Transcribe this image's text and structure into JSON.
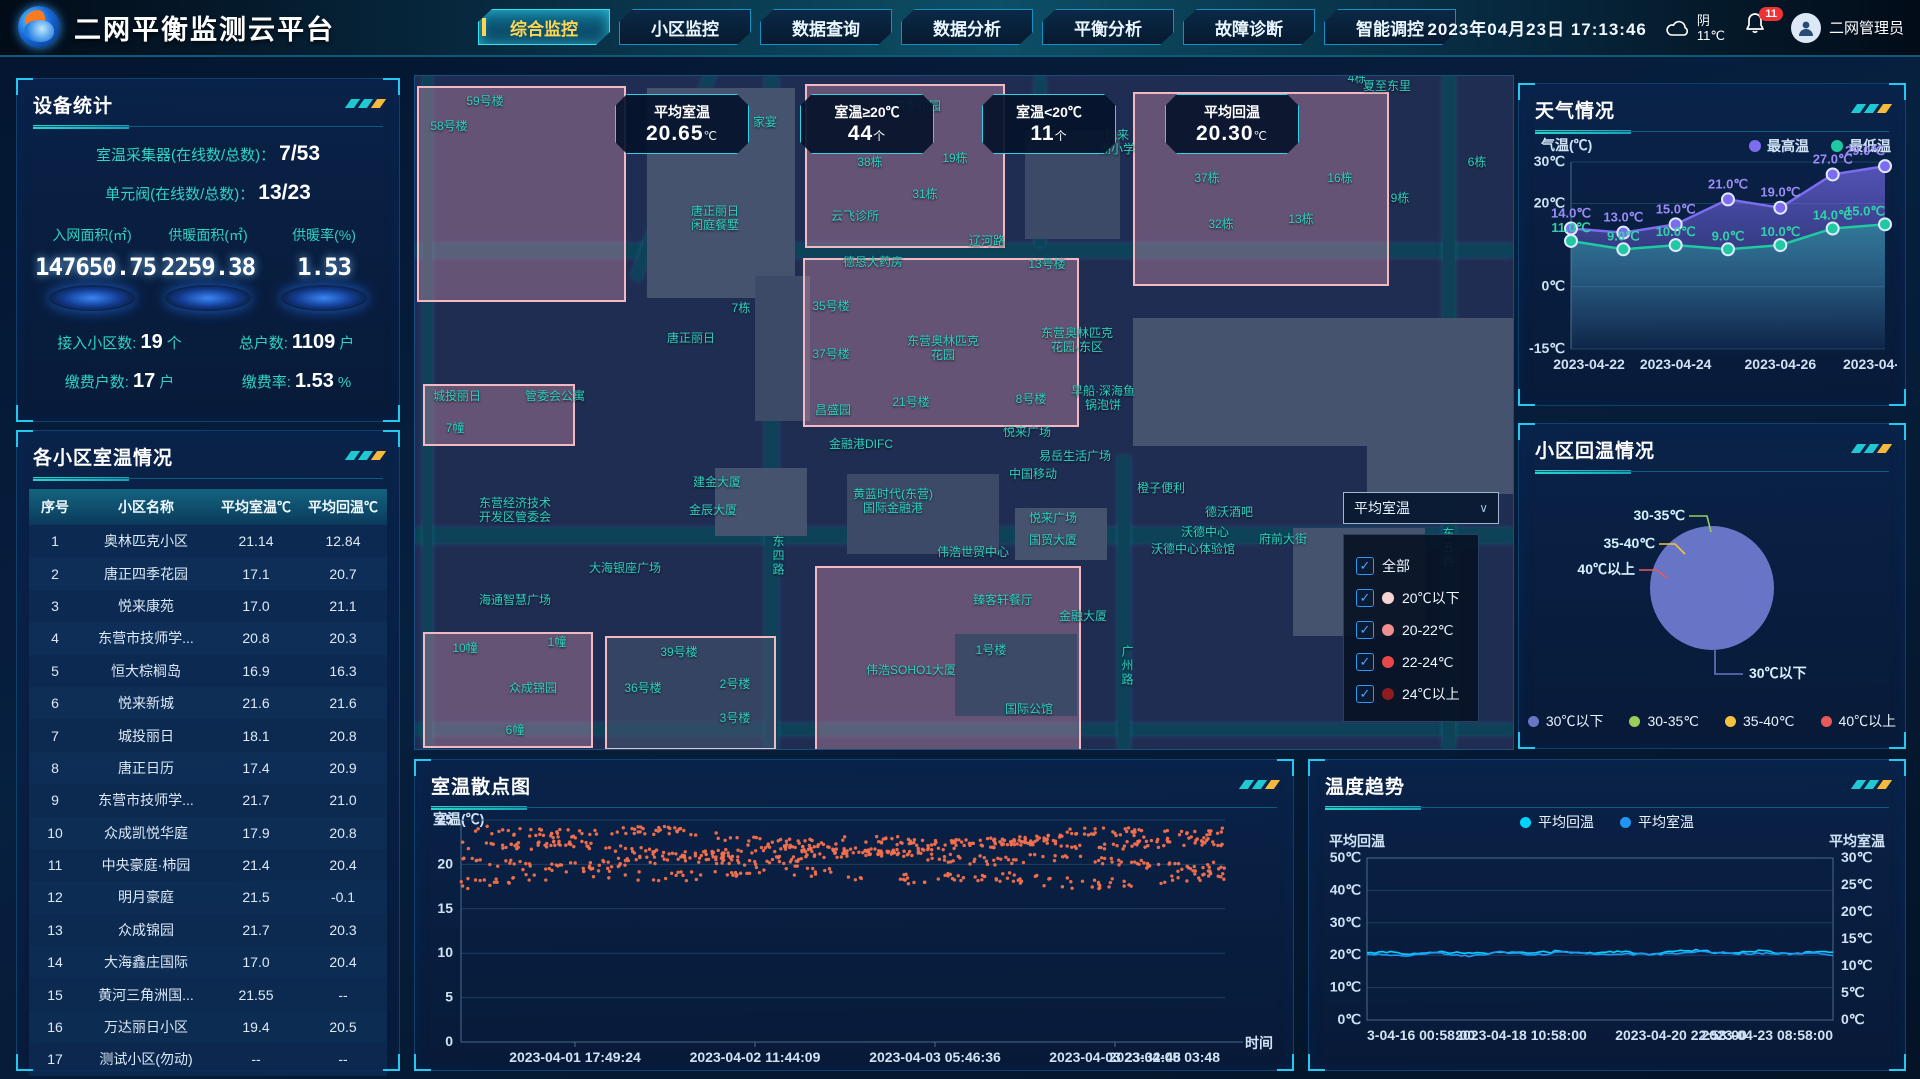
{
  "header": {
    "title": "二网平衡监测云平台",
    "nav": [
      {
        "label": "综合监控",
        "active": true
      },
      {
        "label": "小区监控",
        "active": false
      },
      {
        "label": "数据查询",
        "active": false
      },
      {
        "label": "数据分析",
        "active": false
      },
      {
        "label": "平衡分析",
        "active": false
      },
      {
        "label": "故障诊断",
        "active": false
      },
      {
        "label": "智能调控",
        "active": false
      }
    ],
    "datetime": "2023年04月23日 17:13:46",
    "weather_text": "阴",
    "weather_temp": "11℃",
    "notification_count": "11",
    "username": "二网管理员"
  },
  "device_stats": {
    "title": "设备统计",
    "rows": [
      {
        "label": "室温采集器(在线数/总数)：",
        "value": "7/53"
      },
      {
        "label": "单元阀(在线数/总数)：",
        "value": "13/23"
      }
    ],
    "gauges": [
      {
        "label": "入网面积(㎡)",
        "value": "147650.75"
      },
      {
        "label": "供暖面积(㎡)",
        "value": "2259.38"
      },
      {
        "label": "供暖率(%)",
        "value": "1.53"
      }
    ],
    "kpis": [
      {
        "label": "接入小区数:",
        "value": "19",
        "unit": "个"
      },
      {
        "label": "总户数:",
        "value": "1109",
        "unit": "户"
      },
      {
        "label": "缴费户数:",
        "value": "17",
        "unit": "户"
      },
      {
        "label": "缴费率:",
        "value": "1.53",
        "unit": "%"
      }
    ]
  },
  "community_table": {
    "title": "各小区室温情况",
    "columns": [
      "序号",
      "小区名称",
      "平均室温℃",
      "平均回温℃"
    ],
    "rows": [
      [
        "1",
        "奥林匹克小区",
        "21.14",
        "12.84"
      ],
      [
        "2",
        "唐正四季花园",
        "17.1",
        "20.7"
      ],
      [
        "3",
        "悦来康苑",
        "17.0",
        "21.1"
      ],
      [
        "4",
        "东营市技师学...",
        "20.8",
        "20.3"
      ],
      [
        "5",
        "恒大棕榈岛",
        "16.9",
        "16.3"
      ],
      [
        "6",
        "悦来新城",
        "21.6",
        "21.6"
      ],
      [
        "7",
        "城投丽日",
        "18.1",
        "20.8"
      ],
      [
        "8",
        "唐正日历",
        "17.4",
        "20.9"
      ],
      [
        "9",
        "东营市技师学...",
        "21.7",
        "21.0"
      ],
      [
        "10",
        "众成凯悦华庭",
        "17.9",
        "20.8"
      ],
      [
        "11",
        "中央豪庭·柿园",
        "21.4",
        "20.4"
      ],
      [
        "12",
        "明月豪庭",
        "21.5",
        "-0.1"
      ],
      [
        "13",
        "众成锦园",
        "21.7",
        "20.3"
      ],
      [
        "14",
        "大海鑫庄国际",
        "17.0",
        "20.4"
      ],
      [
        "15",
        "黄河三角洲国...",
        "21.55",
        "--"
      ],
      [
        "16",
        "万达丽日小区",
        "19.4",
        "20.5"
      ],
      [
        "17",
        "测试小区(勿动)",
        "--",
        "--"
      ]
    ]
  },
  "map": {
    "badges": [
      {
        "label": "平均室温",
        "value": "20.65",
        "unit": "℃",
        "x": 200
      },
      {
        "label": "室温≥20℃",
        "value": "44",
        "unit": "个",
        "x": 385
      },
      {
        "label": "室温<20℃",
        "value": "11",
        "unit": "个",
        "x": 567
      },
      {
        "label": "平均回温",
        "value": "20.30",
        "unit": "℃",
        "x": 750
      }
    ],
    "filter": {
      "selected": "平均室温",
      "chevron": "∨",
      "options": [
        {
          "label": "全部",
          "checked": true,
          "dot": ""
        },
        {
          "label": "20℃以下",
          "checked": true,
          "dot": "#f7d4d4"
        },
        {
          "label": "20-22℃",
          "checked": true,
          "dot": "#ef8f8f"
        },
        {
          "label": "22-24℃",
          "checked": true,
          "dot": "#e84848"
        },
        {
          "label": "24℃以上",
          "checked": true,
          "dot": "#8f1d1d"
        }
      ]
    },
    "blocks": [
      {
        "x": 2,
        "y": 10,
        "w": 205,
        "h": 212,
        "k": "pink"
      },
      {
        "x": 232,
        "y": 12,
        "w": 148,
        "h": 210,
        "k": "s"
      },
      {
        "x": 390,
        "y": 8,
        "w": 196,
        "h": 160,
        "k": "pink"
      },
      {
        "x": 610,
        "y": 55,
        "w": 95,
        "h": 108,
        "k": "s2"
      },
      {
        "x": 718,
        "y": 16,
        "w": 252,
        "h": 190,
        "k": "pink"
      },
      {
        "x": 952,
        "y": 242,
        "w": 146,
        "h": 176,
        "k": "s"
      },
      {
        "x": 340,
        "y": 200,
        "w": 55,
        "h": 145,
        "k": "s2"
      },
      {
        "x": 388,
        "y": 182,
        "w": 272,
        "h": 165,
        "k": "pink"
      },
      {
        "x": 718,
        "y": 242,
        "w": 252,
        "h": 128,
        "k": "s"
      },
      {
        "x": 8,
        "y": 308,
        "w": 148,
        "h": 58,
        "k": "pink"
      },
      {
        "x": 300,
        "y": 392,
        "w": 92,
        "h": 68,
        "k": "s"
      },
      {
        "x": 432,
        "y": 398,
        "w": 152,
        "h": 80,
        "k": "s2"
      },
      {
        "x": 600,
        "y": 432,
        "w": 92,
        "h": 52,
        "k": "s"
      },
      {
        "x": 878,
        "y": 452,
        "w": 132,
        "h": 108,
        "k": "s"
      },
      {
        "x": 8,
        "y": 556,
        "w": 166,
        "h": 112,
        "k": "pink"
      },
      {
        "x": 190,
        "y": 560,
        "w": 167,
        "h": 110,
        "k": "pinkline"
      },
      {
        "x": 400,
        "y": 490,
        "w": 262,
        "h": 182,
        "k": "pink"
      },
      {
        "x": 540,
        "y": 558,
        "w": 122,
        "h": 82,
        "k": "s2"
      }
    ],
    "roads": [
      {
        "x": 0,
        "y": 168,
        "w": 1098,
        "h": 13,
        "r": 0
      },
      {
        "x": 0,
        "y": 452,
        "w": 1098,
        "h": 15,
        "r": 0
      },
      {
        "x": 0,
        "y": 648,
        "w": 1098,
        "h": 11,
        "r": 0
      },
      {
        "x": 350,
        "y": 0,
        "w": 13,
        "h": 673,
        "r": 0
      },
      {
        "x": 703,
        "y": 380,
        "w": 12,
        "h": 293,
        "r": 0
      },
      {
        "x": 1028,
        "y": 0,
        "w": 12,
        "h": 673,
        "r": 0
      },
      {
        "x": 620,
        "y": 0,
        "w": 10,
        "h": 170,
        "r": 0
      },
      {
        "x": 8,
        "y": 0,
        "w": 9,
        "h": 673,
        "r": 0
      },
      {
        "x": 255,
        "y": -20,
        "w": 10,
        "h": 230,
        "r": 20
      }
    ],
    "labels": [
      {
        "t": "59号楼",
        "x": 70,
        "y": 25
      },
      {
        "t": "58号楼",
        "x": 34,
        "y": 50
      },
      {
        "t": "家宴",
        "x": 350,
        "y": 46
      },
      {
        "t": "四季花园",
        "x": 502,
        "y": 30
      },
      {
        "t": "夏至东里",
        "x": 972,
        "y": 10
      },
      {
        "t": "4栋",
        "x": 942,
        "y": 2
      },
      {
        "t": "38栋",
        "x": 455,
        "y": 86
      },
      {
        "t": "19栋",
        "x": 540,
        "y": 82
      },
      {
        "t": "31栋",
        "x": 510,
        "y": 118
      },
      {
        "t": "悦来\n湖小学",
        "x": 702,
        "y": 66
      },
      {
        "t": "6栋",
        "x": 1062,
        "y": 86
      },
      {
        "t": "16栋",
        "x": 925,
        "y": 102
      },
      {
        "t": "37栋",
        "x": 792,
        "y": 102
      },
      {
        "t": "9栋",
        "x": 985,
        "y": 122
      },
      {
        "t": "13栋",
        "x": 886,
        "y": 143
      },
      {
        "t": "32栋",
        "x": 806,
        "y": 148
      },
      {
        "t": "云飞诊所",
        "x": 440,
        "y": 140
      },
      {
        "t": "辽河路",
        "x": 572,
        "y": 165
      },
      {
        "t": "13号楼",
        "x": 632,
        "y": 188
      },
      {
        "t": "唐正丽日\n闲庭餐墅",
        "x": 300,
        "y": 142
      },
      {
        "t": "德恳大药房",
        "x": 458,
        "y": 186
      },
      {
        "t": "7栋",
        "x": 326,
        "y": 232
      },
      {
        "t": "35号楼",
        "x": 416,
        "y": 230
      },
      {
        "t": "37号楼",
        "x": 416,
        "y": 278
      },
      {
        "t": "东营奥林匹克\n花园",
        "x": 528,
        "y": 272
      },
      {
        "t": "东营奥林匹克\n花园-东区",
        "x": 662,
        "y": 264
      },
      {
        "t": "唐正丽日",
        "x": 276,
        "y": 262
      },
      {
        "t": "21号楼",
        "x": 496,
        "y": 326
      },
      {
        "t": "8号楼",
        "x": 616,
        "y": 323
      },
      {
        "t": "早船·深海鱼\n锅泡饼",
        "x": 688,
        "y": 322
      },
      {
        "t": "昌盛园",
        "x": 418,
        "y": 334
      },
      {
        "t": "悦来广场",
        "x": 612,
        "y": 356
      },
      {
        "t": "金融港DIFC",
        "x": 446,
        "y": 368
      },
      {
        "t": "城投丽日",
        "x": 42,
        "y": 320
      },
      {
        "t": "7幢",
        "x": 40,
        "y": 352
      },
      {
        "t": "管委会公寓",
        "x": 140,
        "y": 320
      },
      {
        "t": "易岳生活广场",
        "x": 660,
        "y": 380
      },
      {
        "t": "中国移动",
        "x": 618,
        "y": 398
      },
      {
        "t": "建金大厦",
        "x": 302,
        "y": 406
      },
      {
        "t": "金辰大厦",
        "x": 298,
        "y": 434
      },
      {
        "t": "黄蓝时代(东营)\n国际金融港",
        "x": 478,
        "y": 425
      },
      {
        "t": "悦来广场",
        "x": 638,
        "y": 442
      },
      {
        "t": "国贸大厦",
        "x": 638,
        "y": 464
      },
      {
        "t": "橙子便利",
        "x": 746,
        "y": 412
      },
      {
        "t": "德沃酒吧",
        "x": 814,
        "y": 436
      },
      {
        "t": "沃德中心",
        "x": 790,
        "y": 456
      },
      {
        "t": "沃德中心体验馆",
        "x": 778,
        "y": 473
      },
      {
        "t": "东营经济技术\n开发区管委会",
        "x": 100,
        "y": 434
      },
      {
        "t": "大海银座广场",
        "x": 210,
        "y": 492
      },
      {
        "t": "海通智慧广场",
        "x": 100,
        "y": 524
      },
      {
        "t": "东四路",
        "x": 363,
        "y": 480,
        "v": 1
      },
      {
        "t": "伟浩世贸中心",
        "x": 558,
        "y": 476
      },
      {
        "t": "臻客轩餐厅",
        "x": 588,
        "y": 524
      },
      {
        "t": "金融大厦",
        "x": 668,
        "y": 540
      },
      {
        "t": "府前大街",
        "x": 868,
        "y": 463
      },
      {
        "t": "东五路",
        "x": 1033,
        "y": 472,
        "v": 1
      },
      {
        "t": "广州路",
        "x": 712,
        "y": 590,
        "v": 1
      },
      {
        "t": "众成锦园",
        "x": 118,
        "y": 612
      },
      {
        "t": "10幢",
        "x": 50,
        "y": 572
      },
      {
        "t": "1幢",
        "x": 142,
        "y": 566
      },
      {
        "t": "39号楼",
        "x": 264,
        "y": 576
      },
      {
        "t": "36号楼",
        "x": 228,
        "y": 612
      },
      {
        "t": "2号楼",
        "x": 320,
        "y": 608
      },
      {
        "t": "3号楼",
        "x": 320,
        "y": 642
      },
      {
        "t": "6幢",
        "x": 100,
        "y": 654
      },
      {
        "t": "1号楼",
        "x": 576,
        "y": 574
      },
      {
        "t": "伟浩SOHO1大厦",
        "x": 496,
        "y": 594
      },
      {
        "t": "国际公馆",
        "x": 614,
        "y": 633
      }
    ]
  },
  "chart_data": [
    {
      "id": "weather",
      "type": "line",
      "title": "天气情况",
      "ylabel": "气温(℃)",
      "x": [
        "2023-04-22",
        "2023-04-23",
        "2023-04-24",
        "2023-04-25",
        "2023-04-26",
        "2023-04-27",
        "2023-04-28"
      ],
      "x_tick_labels": [
        "2023-04-22",
        "2023-04-24",
        "2023-04-26",
        "2023-04-"
      ],
      "y_ticks": [
        {
          "label": "30℃",
          "v": 30
        },
        {
          "label": "20℃",
          "v": 20
        },
        {
          "label": "0℃",
          "v": 0
        },
        {
          "label": "-15℃",
          "v": -15
        }
      ],
      "ylim": [
        -15,
        30
      ],
      "legend_position": "top-right",
      "series": [
        {
          "name": "最高温",
          "color": "#7b6cf0",
          "label_color": "#9b8cf7",
          "values": [
            14.0,
            13.0,
            15.0,
            21.0,
            19.0,
            27.0,
            29.0
          ]
        },
        {
          "name": "最低温",
          "color": "#1fc9a2",
          "label_color": "#2fd3a8",
          "values": [
            11.0,
            9.0,
            10.0,
            9.0,
            10.0,
            14.0,
            15.0
          ]
        }
      ]
    },
    {
      "id": "rewarming-pie",
      "type": "pie",
      "title": "小区回温情况",
      "slices": [
        {
          "label": "30℃以下",
          "value": 100,
          "color": "#6675c5"
        },
        {
          "label": "30-35℃",
          "value": 0,
          "color": "#9acd5a"
        },
        {
          "label": "35-40℃",
          "value": 0,
          "color": "#f5c242"
        },
        {
          "label": "40℃以上",
          "value": 0,
          "color": "#e85a5a"
        }
      ],
      "legend_position": "bottom"
    },
    {
      "id": "indoor-scatter",
      "type": "scatter",
      "title": "室温散点图",
      "ylabel": "室温(℃)",
      "xlabel": "时间",
      "y_ticks": [
        25,
        20,
        15,
        10,
        5,
        0
      ],
      "ylim": [
        0,
        25
      ],
      "x_tick_labels": [
        "2023-04-01 17:49:24",
        "2023-04-02 11:44:09",
        "2023-04-03 05:46:36",
        "2023-04-03 23:32:48",
        "2023-04-05 03:48"
      ],
      "point_color": "#f4714d",
      "bands": [
        {
          "center": 23.1,
          "count": 215,
          "jitter": 0.5,
          "amp": 0.7,
          "phase": 0.8
        },
        {
          "center": 21.9,
          "count": 235,
          "jitter": 0.45,
          "amp": 0.55,
          "phase": 2.1
        },
        {
          "center": 20.5,
          "count": 215,
          "jitter": 0.5,
          "amp": 0.5,
          "phase": 4.0
        },
        {
          "center": 18.6,
          "count": 150,
          "jitter": 0.6,
          "amp": 0.5,
          "phase": 5.3
        }
      ]
    },
    {
      "id": "temp-trend",
      "type": "line",
      "title": "温度趋势",
      "axis_left_label": "平均回温",
      "axis_right_label": "平均室温",
      "y_ticks_left": [
        {
          "label": "50℃",
          "v": 50
        },
        {
          "label": "40℃",
          "v": 40
        },
        {
          "label": "30℃",
          "v": 30
        },
        {
          "label": "20℃",
          "v": 20
        },
        {
          "label": "10℃",
          "v": 10
        },
        {
          "label": "0℃",
          "v": 0
        }
      ],
      "y_ticks_right": [
        {
          "label": "30℃",
          "v": 30
        },
        {
          "label": "25℃",
          "v": 25
        },
        {
          "label": "20℃",
          "v": 20
        },
        {
          "label": "15℃",
          "v": 15
        },
        {
          "label": "10℃",
          "v": 10
        },
        {
          "label": "5℃",
          "v": 5
        },
        {
          "label": "0℃",
          "v": 0
        }
      ],
      "x_tick_labels": [
        "3-04-16 00:58:00",
        "2023-04-18 10:58:00",
        "2023-04-20 22:58:00",
        "2023-04-23 08:58:00"
      ],
      "legend_position": "top-center",
      "series": [
        {
          "name": "平均回温",
          "color": "#00d2ff",
          "axis": "left",
          "values": [
            20.6,
            20.7,
            20.5,
            20.8,
            21.0,
            20.6,
            20.4,
            20.7,
            21.2,
            20.8,
            20.5,
            20.9,
            21.4,
            21.0,
            20.6,
            20.8,
            21.1,
            20.7,
            20.5,
            20.9,
            21.3,
            21.6,
            21.0,
            20.7,
            20.9,
            21.2,
            20.8,
            20.6,
            20.9,
            20.7
          ]
        },
        {
          "name": "平均室温",
          "color": "#2196f3",
          "axis": "right",
          "values": [
            20.2,
            20.3,
            20.1,
            20.4,
            20.6,
            20.2,
            20.0,
            20.3,
            20.8,
            20.4,
            20.1,
            20.5,
            21.0,
            20.6,
            20.2,
            20.4,
            20.7,
            20.3,
            20.1,
            20.5,
            20.9,
            21.2,
            20.6,
            20.3,
            20.5,
            20.8,
            20.4,
            20.2,
            20.5,
            20.3
          ]
        }
      ]
    }
  ]
}
